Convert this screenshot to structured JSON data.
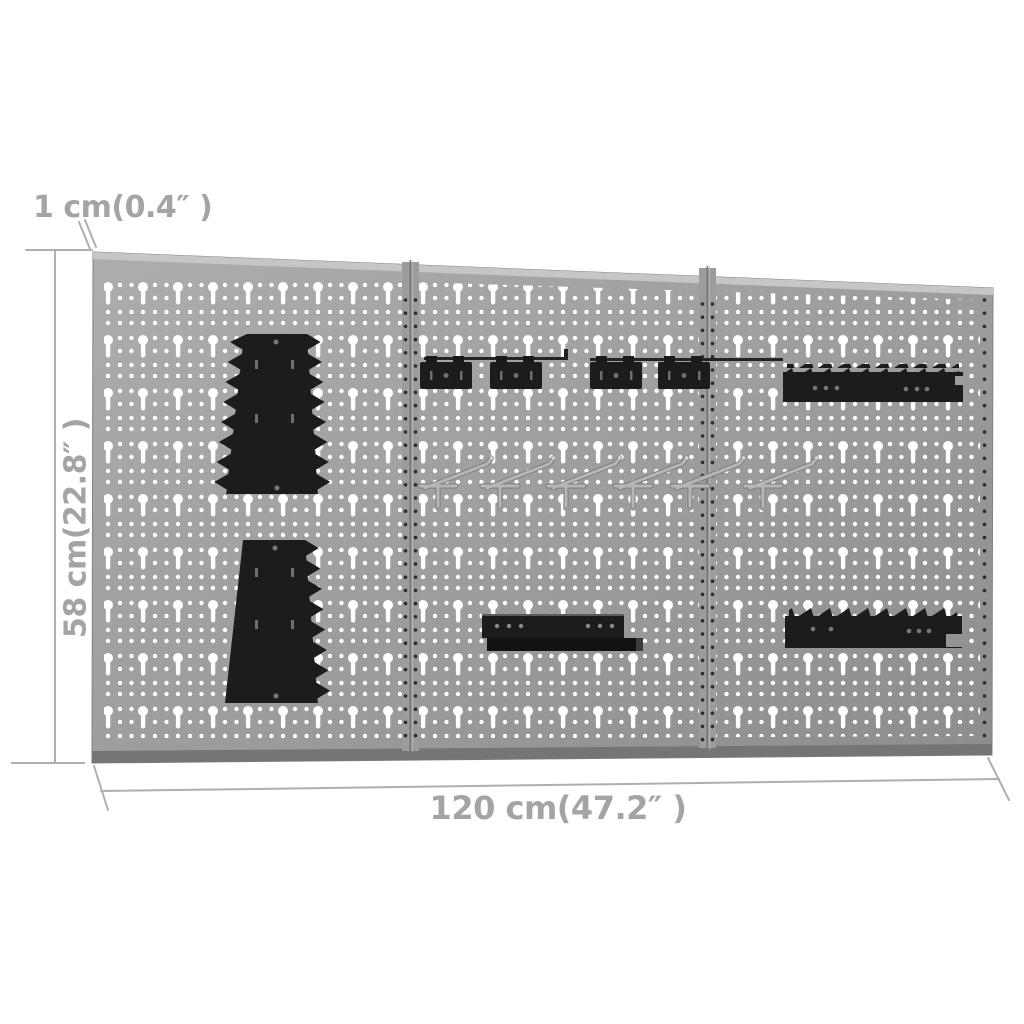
{
  "scene": {
    "background": "#ffffff",
    "description": "Dimension diagram of a 3-panel metal pegboard wall set with tool-holder accessories"
  },
  "labels": {
    "thickness": "1 cm(0.4″ )",
    "height": "58 cm(22.8″ )",
    "width": "120 cm(47.2″ )"
  },
  "board": {
    "panel_count": 3,
    "accessories": {
      "wrench_holders": 2,
      "clip_bracket_rails": 2,
      "clip_brackets": 4,
      "chrome_hooks": 6,
      "serrated_tool_bars": 2,
      "shelf_brackets": 1
    }
  },
  "colors": {
    "scene_bg": "#ffffff",
    "panel_light": "#adadad",
    "panel_mid": "#9c9c9c",
    "panel_dark": "#8d8d8d",
    "panel_top_bevel": "#c6c6c6",
    "panel_bottom_bevel": "#757575",
    "hole": "#ffffff",
    "edge_hole": "#2e2e2e",
    "divider": "#767676",
    "accessory_black": "#1c1c1c",
    "accessory_slot": "#6e6e6e",
    "chrome": "#b6b6b6",
    "chrome_dark": "#828282",
    "dim_line": "#afafaf",
    "dim_text": "#a4a4a4"
  }
}
